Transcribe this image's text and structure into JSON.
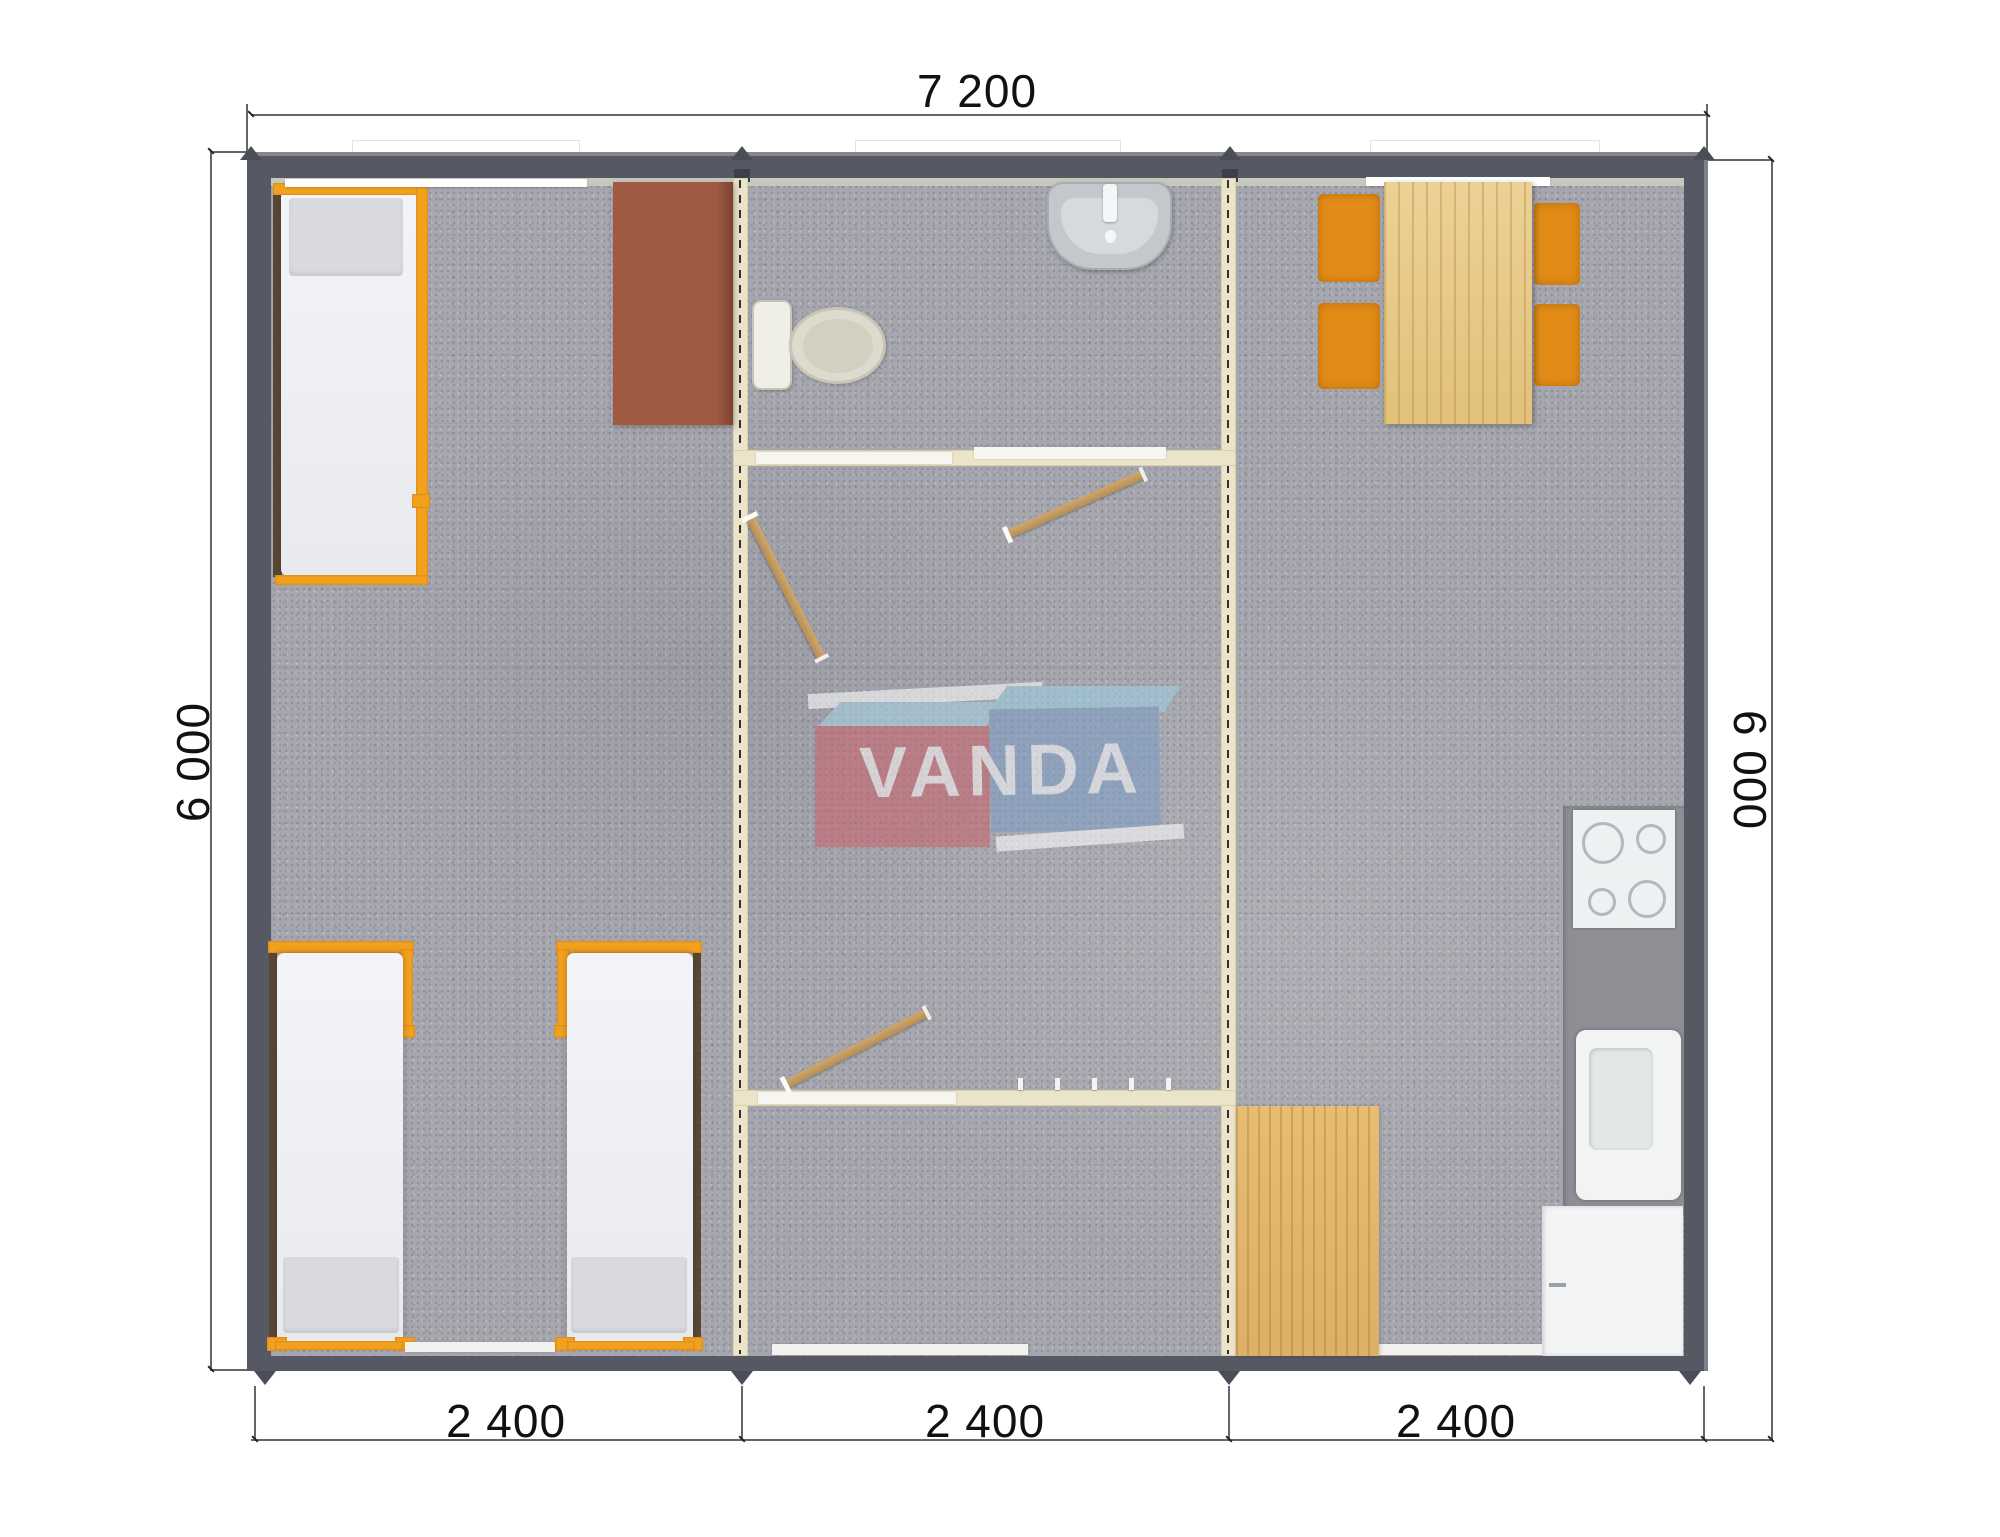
{
  "dimensions": {
    "top": "7 200",
    "left": "6 000",
    "right": "6 000",
    "modules": [
      "2 400",
      "2 400",
      "2 400"
    ]
  },
  "watermark": {
    "text": "VANDA"
  },
  "palette": {
    "exterior_wall": "#565963",
    "partition_wall": "#ece4c8",
    "floor_carpet": "#a6a6ae",
    "bed_frame_orange": "#f2a11e",
    "chair_orange": "#e28c17",
    "table_wood": "#e8cb88",
    "wardrobe_brown": "#a15a42",
    "door_wood": "#c7a066",
    "counter_gray": "#8e8f95",
    "logo_red": "#c9646c",
    "logo_blue": "#7e9dc4",
    "logo_light_blue": "#9ecfe2"
  },
  "objects": [
    "single-bed",
    "single-bed",
    "single-bed",
    "wardrobe",
    "toilet",
    "washbasin",
    "interior-door",
    "interior-door",
    "interior-door",
    "coat-hooks",
    "dining-table",
    "chair",
    "chair",
    "chair",
    "chair",
    "cooktop",
    "kitchen-sink",
    "kitchen-cabinet",
    "wood-floor-mat"
  ]
}
